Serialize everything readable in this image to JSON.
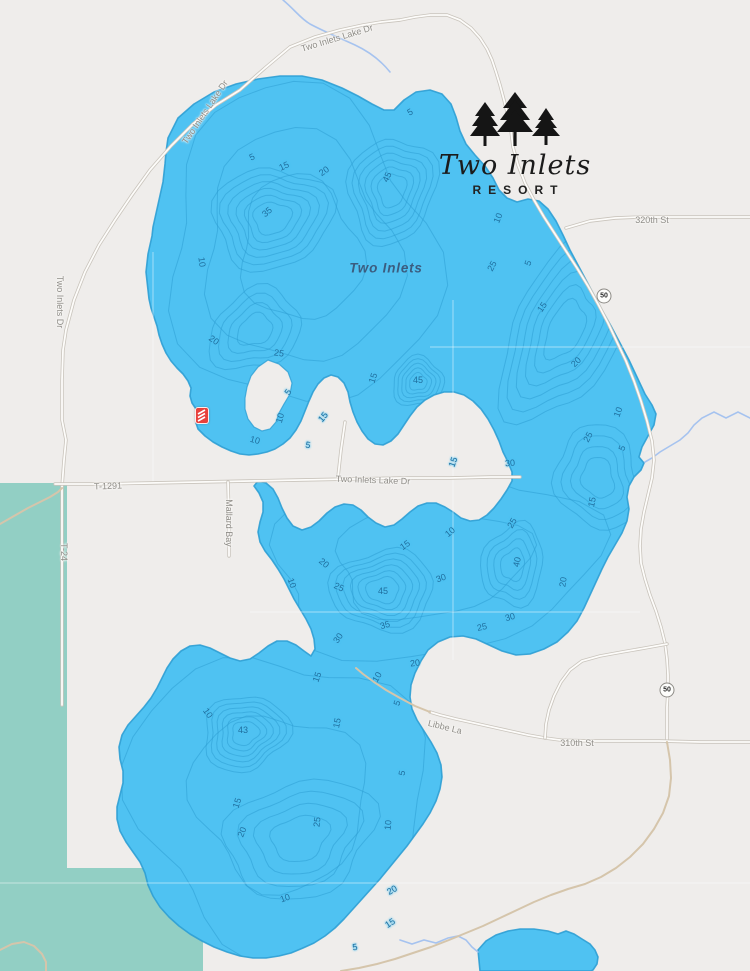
{
  "map": {
    "lake_label": {
      "text": "Two Inlets",
      "x": 386,
      "y": 268
    },
    "logo": {
      "name_script": "Two Inlets",
      "resort_caps": "RESORT"
    },
    "colors": {
      "lake": "#4fc2f2",
      "contour": "#2d9fd4",
      "land": "#efedeb",
      "green_area": "#92cfc4",
      "stream": "#a6c3ef",
      "marker_red": "#e8413c",
      "road_label": "#8f8d88",
      "depth_label": "#1f6f9f",
      "lake_label": "#3b5d80"
    },
    "marker": {
      "name": "resort-location",
      "x": 195,
      "y": 407
    },
    "highway_shields": [
      {
        "label": "50",
        "x": 604,
        "y": 296
      },
      {
        "label": "50",
        "x": 667,
        "y": 690
      }
    ],
    "road_labels": [
      {
        "label": "Two Inlets Lake Dr",
        "x": 205,
        "y": 112,
        "rotation": -56
      },
      {
        "label": "Two Inlets Lake Dr",
        "x": 337,
        "y": 38,
        "rotation": -17
      },
      {
        "label": "Two Inlets Dr",
        "x": 60,
        "y": 302,
        "rotation": 90
      },
      {
        "label": "T-1291",
        "x": 108,
        "y": 486,
        "rotation": -2
      },
      {
        "label": "Two Inlets Lake Dr",
        "x": 373,
        "y": 480,
        "rotation": 2
      },
      {
        "label": "Mallard Bay",
        "x": 229,
        "y": 523,
        "rotation": 90
      },
      {
        "label": "T-24",
        "x": 64,
        "y": 552,
        "rotation": 90
      },
      {
        "label": "320th St",
        "x": 652,
        "y": 220,
        "rotation": 0
      },
      {
        "label": "310th St",
        "x": 577,
        "y": 743,
        "rotation": 0
      },
      {
        "label": "Libbe La",
        "x": 445,
        "y": 727,
        "rotation": 14
      }
    ],
    "depth_labels": [
      {
        "value": "5",
        "x": 252,
        "y": 157,
        "rotation": -25
      },
      {
        "value": "15",
        "x": 284,
        "y": 166,
        "rotation": -25
      },
      {
        "value": "20",
        "x": 324,
        "y": 171,
        "rotation": -35
      },
      {
        "value": "45",
        "x": 387,
        "y": 177,
        "rotation": -65
      },
      {
        "value": "35",
        "x": 267,
        "y": 212,
        "rotation": -40
      },
      {
        "value": "10",
        "x": 202,
        "y": 262,
        "rotation": 82
      },
      {
        "value": "20",
        "x": 214,
        "y": 340,
        "rotation": 35
      },
      {
        "value": "25",
        "x": 279,
        "y": 353,
        "rotation": 8
      },
      {
        "value": "45",
        "x": 418,
        "y": 380,
        "rotation": 0
      },
      {
        "value": "15",
        "x": 373,
        "y": 378,
        "rotation": -72
      },
      {
        "value": "5",
        "x": 288,
        "y": 392,
        "rotation": -55
      },
      {
        "value": "10",
        "x": 280,
        "y": 418,
        "rotation": -75
      },
      {
        "value": "15",
        "x": 323,
        "y": 417,
        "rotation": -50
      },
      {
        "value": "10",
        "x": 255,
        "y": 440,
        "rotation": 15
      },
      {
        "value": "5",
        "x": 308,
        "y": 445,
        "rotation": 10
      },
      {
        "value": "5",
        "x": 410,
        "y": 112,
        "rotation": -30
      },
      {
        "value": "10",
        "x": 498,
        "y": 218,
        "rotation": -68
      },
      {
        "value": "25",
        "x": 492,
        "y": 266,
        "rotation": -62
      },
      {
        "value": "5",
        "x": 528,
        "y": 263,
        "rotation": -70
      },
      {
        "value": "15",
        "x": 542,
        "y": 307,
        "rotation": -55
      },
      {
        "value": "20",
        "x": 576,
        "y": 362,
        "rotation": -45
      },
      {
        "value": "10",
        "x": 618,
        "y": 412,
        "rotation": -70
      },
      {
        "value": "25",
        "x": 588,
        "y": 437,
        "rotation": -62
      },
      {
        "value": "5",
        "x": 622,
        "y": 448,
        "rotation": -68
      },
      {
        "value": "30",
        "x": 510,
        "y": 463,
        "rotation": -5
      },
      {
        "value": "15",
        "x": 453,
        "y": 462,
        "rotation": -70
      },
      {
        "value": "15",
        "x": 592,
        "y": 502,
        "rotation": -78
      },
      {
        "value": "20",
        "x": 563,
        "y": 582,
        "rotation": -82
      },
      {
        "value": "10",
        "x": 292,
        "y": 583,
        "rotation": 70
      },
      {
        "value": "20",
        "x": 324,
        "y": 563,
        "rotation": 40
      },
      {
        "value": "25",
        "x": 339,
        "y": 587,
        "rotation": 25
      },
      {
        "value": "45",
        "x": 383,
        "y": 591,
        "rotation": 0
      },
      {
        "value": "15",
        "x": 405,
        "y": 545,
        "rotation": -35
      },
      {
        "value": "10",
        "x": 450,
        "y": 532,
        "rotation": -40
      },
      {
        "value": "30",
        "x": 441,
        "y": 578,
        "rotation": -20
      },
      {
        "value": "25",
        "x": 512,
        "y": 523,
        "rotation": -60
      },
      {
        "value": "40",
        "x": 517,
        "y": 562,
        "rotation": -78
      },
      {
        "value": "35",
        "x": 385,
        "y": 625,
        "rotation": -15
      },
      {
        "value": "30",
        "x": 338,
        "y": 638,
        "rotation": -55
      },
      {
        "value": "30",
        "x": 510,
        "y": 617,
        "rotation": -15
      },
      {
        "value": "25",
        "x": 482,
        "y": 627,
        "rotation": -12
      },
      {
        "value": "43",
        "x": 243,
        "y": 730,
        "rotation": 0
      },
      {
        "value": "10",
        "x": 208,
        "y": 713,
        "rotation": 55
      },
      {
        "value": "15",
        "x": 317,
        "y": 677,
        "rotation": -70
      },
      {
        "value": "20",
        "x": 415,
        "y": 663,
        "rotation": -8
      },
      {
        "value": "10",
        "x": 377,
        "y": 677,
        "rotation": -60
      },
      {
        "value": "5",
        "x": 397,
        "y": 703,
        "rotation": -70
      },
      {
        "value": "15",
        "x": 337,
        "y": 723,
        "rotation": -78
      },
      {
        "value": "5",
        "x": 402,
        "y": 773,
        "rotation": -80
      },
      {
        "value": "15",
        "x": 237,
        "y": 803,
        "rotation": -72
      },
      {
        "value": "20",
        "x": 242,
        "y": 832,
        "rotation": -68
      },
      {
        "value": "25",
        "x": 317,
        "y": 822,
        "rotation": -85
      },
      {
        "value": "10",
        "x": 388,
        "y": 825,
        "rotation": -85
      },
      {
        "value": "10",
        "x": 285,
        "y": 898,
        "rotation": -20
      },
      {
        "value": "20",
        "x": 392,
        "y": 890,
        "rotation": -30
      },
      {
        "value": "15",
        "x": 390,
        "y": 923,
        "rotation": -32
      },
      {
        "value": "5",
        "x": 355,
        "y": 947,
        "rotation": -8
      }
    ]
  }
}
